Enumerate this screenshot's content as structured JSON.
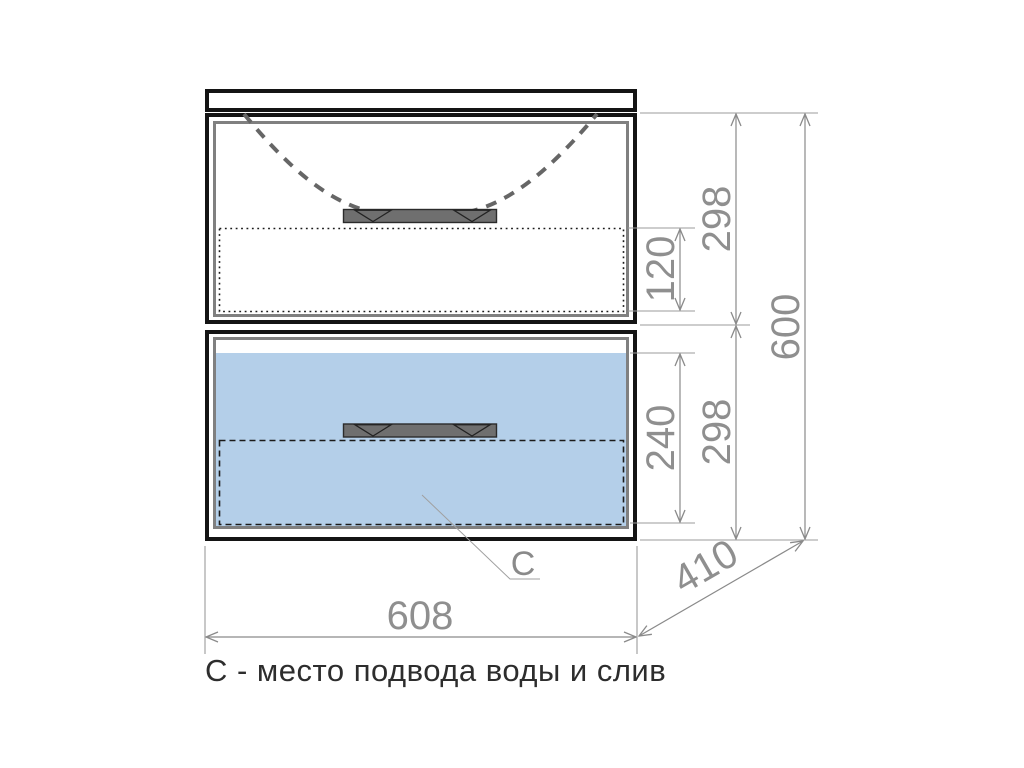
{
  "caption": "С - место подвода воды и слив",
  "labels": {
    "connection_point": "C"
  },
  "dims": {
    "width": "608",
    "height_total": "600",
    "depth": "410",
    "section_top": "298",
    "section_bottom": "298",
    "inner_top": "120",
    "inner_bottom": "240"
  },
  "colors": {
    "highlight_blue": "#b4cfe9",
    "dimension_gray": "#8a8a8a",
    "outline_black": "#141414",
    "frame_gray": "#808080",
    "handle_gray": "#6f6f6f"
  }
}
